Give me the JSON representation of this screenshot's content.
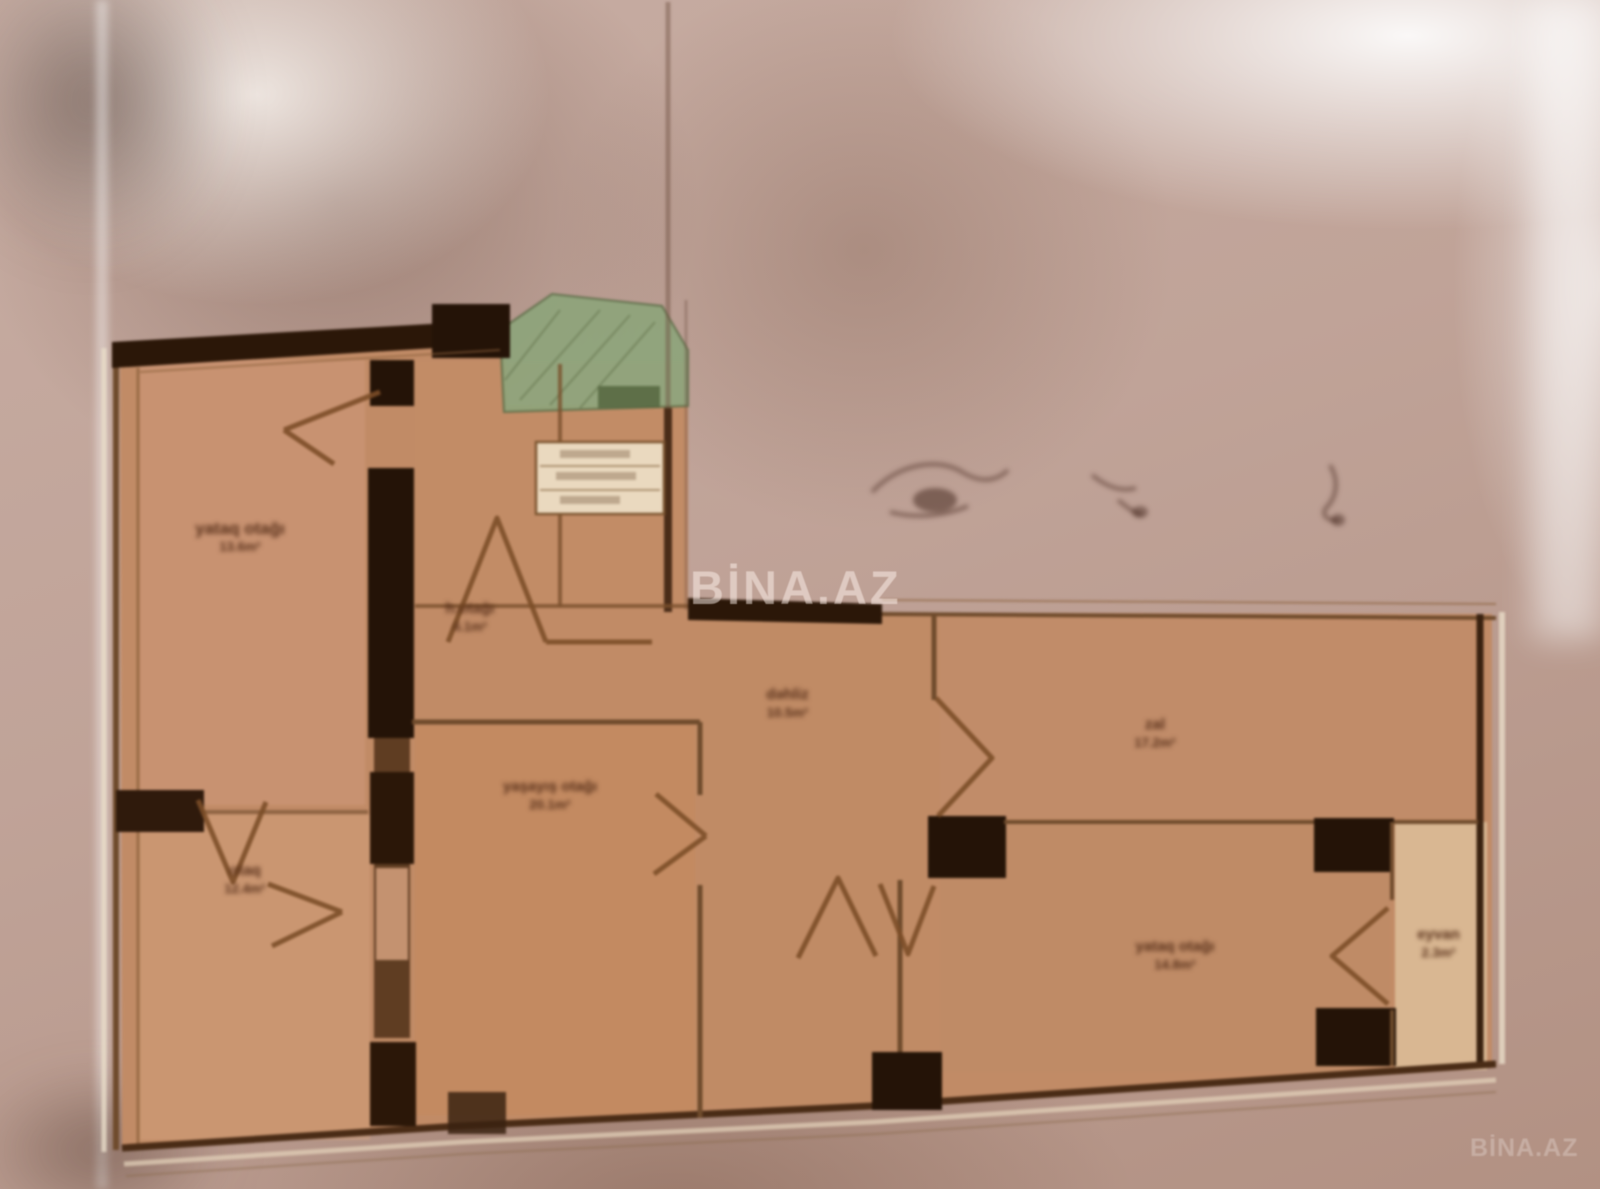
{
  "watermarks": {
    "center": "BİNA.AZ",
    "corner": "BİNA.AZ"
  },
  "rooms": [
    {
      "id": "bedroom-top-left",
      "label": "yataq otağı",
      "area": "13.6m²"
    },
    {
      "id": "room-bottom-left",
      "label": "otaq",
      "area": "12.4m²"
    },
    {
      "id": "bathroom",
      "label": "h.otağı",
      "area": "4.1m²"
    },
    {
      "id": "living-room",
      "label": "yaşayış otağı",
      "area": "20.1m²"
    },
    {
      "id": "hallway",
      "label": "dəhliz",
      "area": "10.5m²"
    },
    {
      "id": "hall-room",
      "label": "zal",
      "area": "17.2m²"
    },
    {
      "id": "bedroom-right",
      "label": "yataq otağı",
      "area": "14.8m²"
    },
    {
      "id": "balcony-right",
      "label": "eyvan",
      "area": "2.3m²"
    }
  ],
  "colors": {
    "room_fill": "#c18b66",
    "wall_dark": "#2b1708",
    "wall_mid": "#6f4b2c",
    "balcony_green": "#8ea47b",
    "paper": "#c0a398"
  }
}
